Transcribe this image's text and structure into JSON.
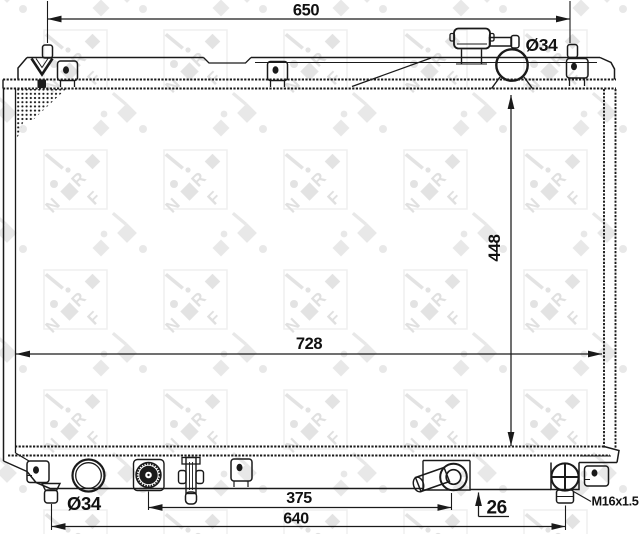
{
  "drawing": {
    "watermark": {
      "brand": "NRF",
      "letters": [
        "N",
        "R",
        "F"
      ]
    },
    "dimensions": {
      "top_width": "650",
      "top_port_diameter": "Ø34",
      "core_height": "448",
      "core_width": "728",
      "outlet_diameter": "Ø34",
      "port_spacing": "375",
      "overall_width": "640",
      "tank_depth": "26",
      "drain_plug_thread": "M16x1.5"
    }
  }
}
